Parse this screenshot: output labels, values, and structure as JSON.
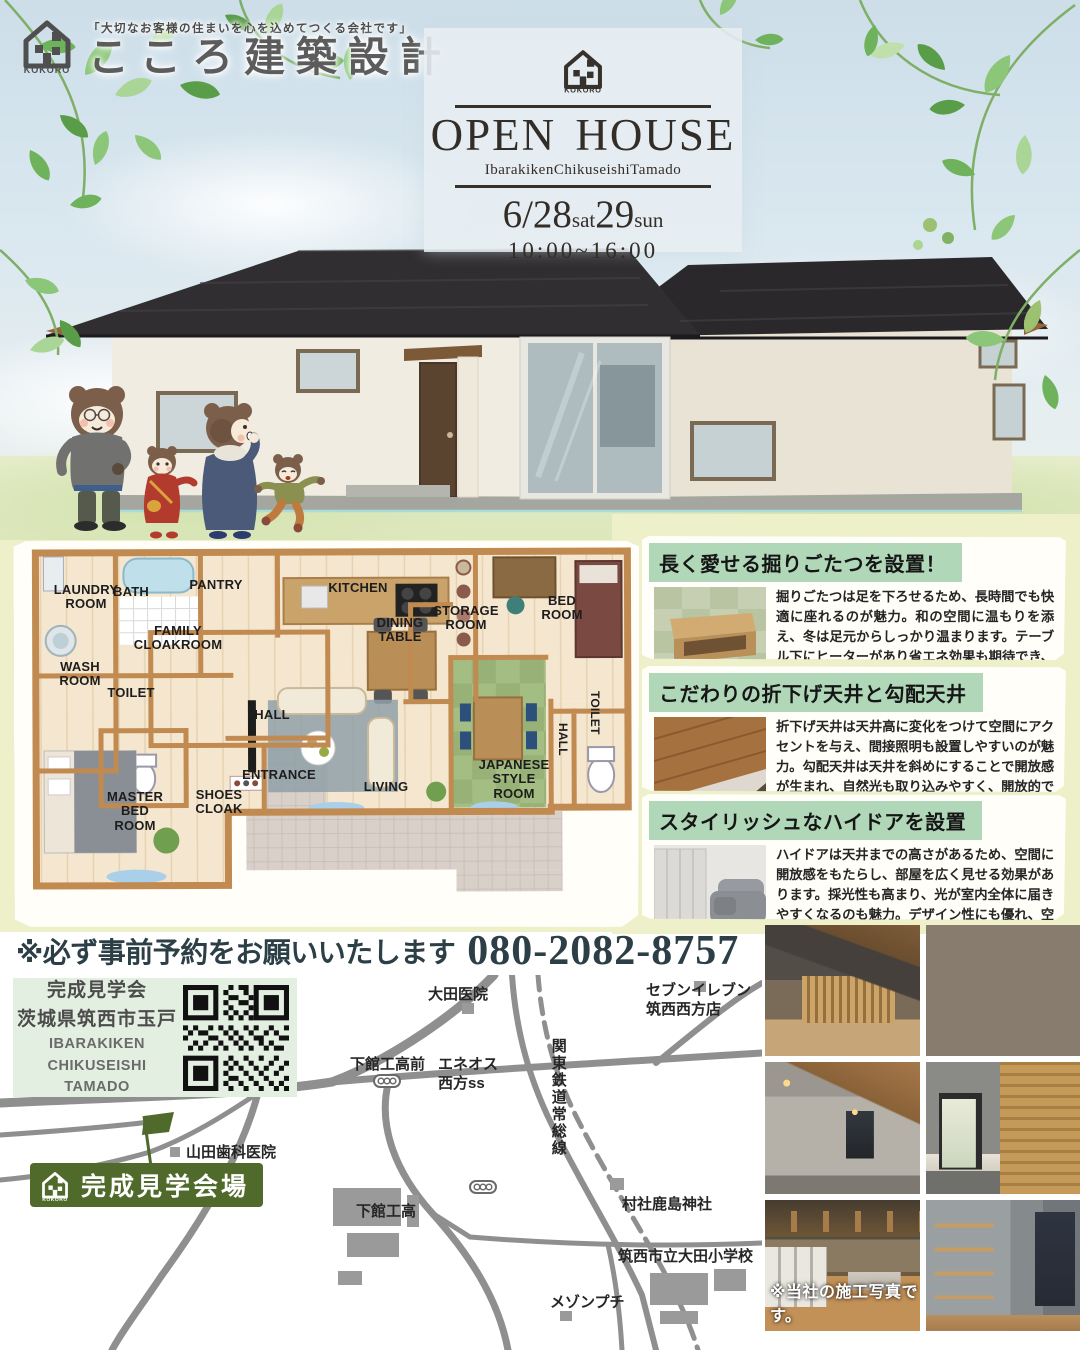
{
  "header": {
    "tagline": "「大切なお客様の住まいを心を込めてつくる会社です」",
    "company": "こころ建築設計",
    "logo_text": "KOKORO"
  },
  "open_house": {
    "logo_text": "KOKORO",
    "title": "OPEN HOUSE",
    "location_en": "IbarakikenChikuseishiTamado",
    "date": {
      "day1": "6/28",
      "day1_suffix": "sat",
      "day2": "29",
      "day2_suffix": "sun"
    },
    "time": "10:00~16:00"
  },
  "floor_plan": {
    "rooms": [
      "LAUNDRY\nROOM",
      "BATH",
      "PANTRY",
      "KITCHEN",
      "DINING\nTABLE",
      "STORAGE\nROOM",
      "BED\nROOM",
      "FAMILY\nCLOAKROOM",
      "WASH\nROOM",
      "TOILET",
      "HALL",
      "TOILET",
      "HALL",
      "MASTER\nBED\nROOM",
      "SHOES\nCLOAK",
      "ENTRANCE",
      "LIVING",
      "JAPANESE\nSTYLE\nROOM"
    ]
  },
  "features": [
    {
      "title": "長く愛せる掘りごたつを設置！",
      "body": "掘りごたつは足を下ろせるため、長時間でも快適に座れるのが魅力。和の空間に温もりを添え、冬は足元からしっかり温まります。テーブル下にヒーターがあり省エネ効果も期待でき、家族や友人との団らんに最適です。"
    },
    {
      "title": "こだわりの折下げ天井と勾配天井",
      "body": "折下げ天井は天井高に変化をつけて空間にアクセントを与え、間接照明も設置しやすいのが魅力。勾配天井は天井を斜めにすることで開放感が生まれ、自然光も取り込みやすく、開放的で明るい空間を演出できます。"
    },
    {
      "title": "スタイリッシュなハイドアを設置",
      "body": "ハイドアは天井までの高さがあるため、空間に開放感をもたらし、部屋を広く見せる効果があります。採光性も高まり、光が室内全体に届きやすくなるのも魅力。デザイン性にも優れ、空間をスタイリッシュに演出できます。"
    }
  ],
  "reservation": {
    "note": "※必ず事前予約をお願いいたします",
    "phone": "080-2082-8757"
  },
  "map": {
    "address": {
      "line1": "完成見学会",
      "line2": "茨城県筑西市玉戸",
      "en1": "IBARAKIKEN",
      "en2": "CHIKUSEISHI",
      "en3": "TAMADO"
    },
    "landmarks": {
      "ota_clinic": "大田医院",
      "seven_eleven": "セブンイレブン\n筑西西方店",
      "shimodate_mae": "下館工高前",
      "eneos": "エネオス\n西方ss",
      "railway": "関東鉄道常総線",
      "yamada_dental": "山田歯科医院",
      "shimodate_tech": "下館工高",
      "kashima_shrine": "村社鹿島神社",
      "ota_elementary": "筑西市立大田小学校",
      "maison_petit": "メゾンプチ"
    },
    "venue_badge": "完成見学会場",
    "venue_logo_text": "KOKORO"
  },
  "photos": {
    "caption": "※当社の施工写真です。"
  }
}
